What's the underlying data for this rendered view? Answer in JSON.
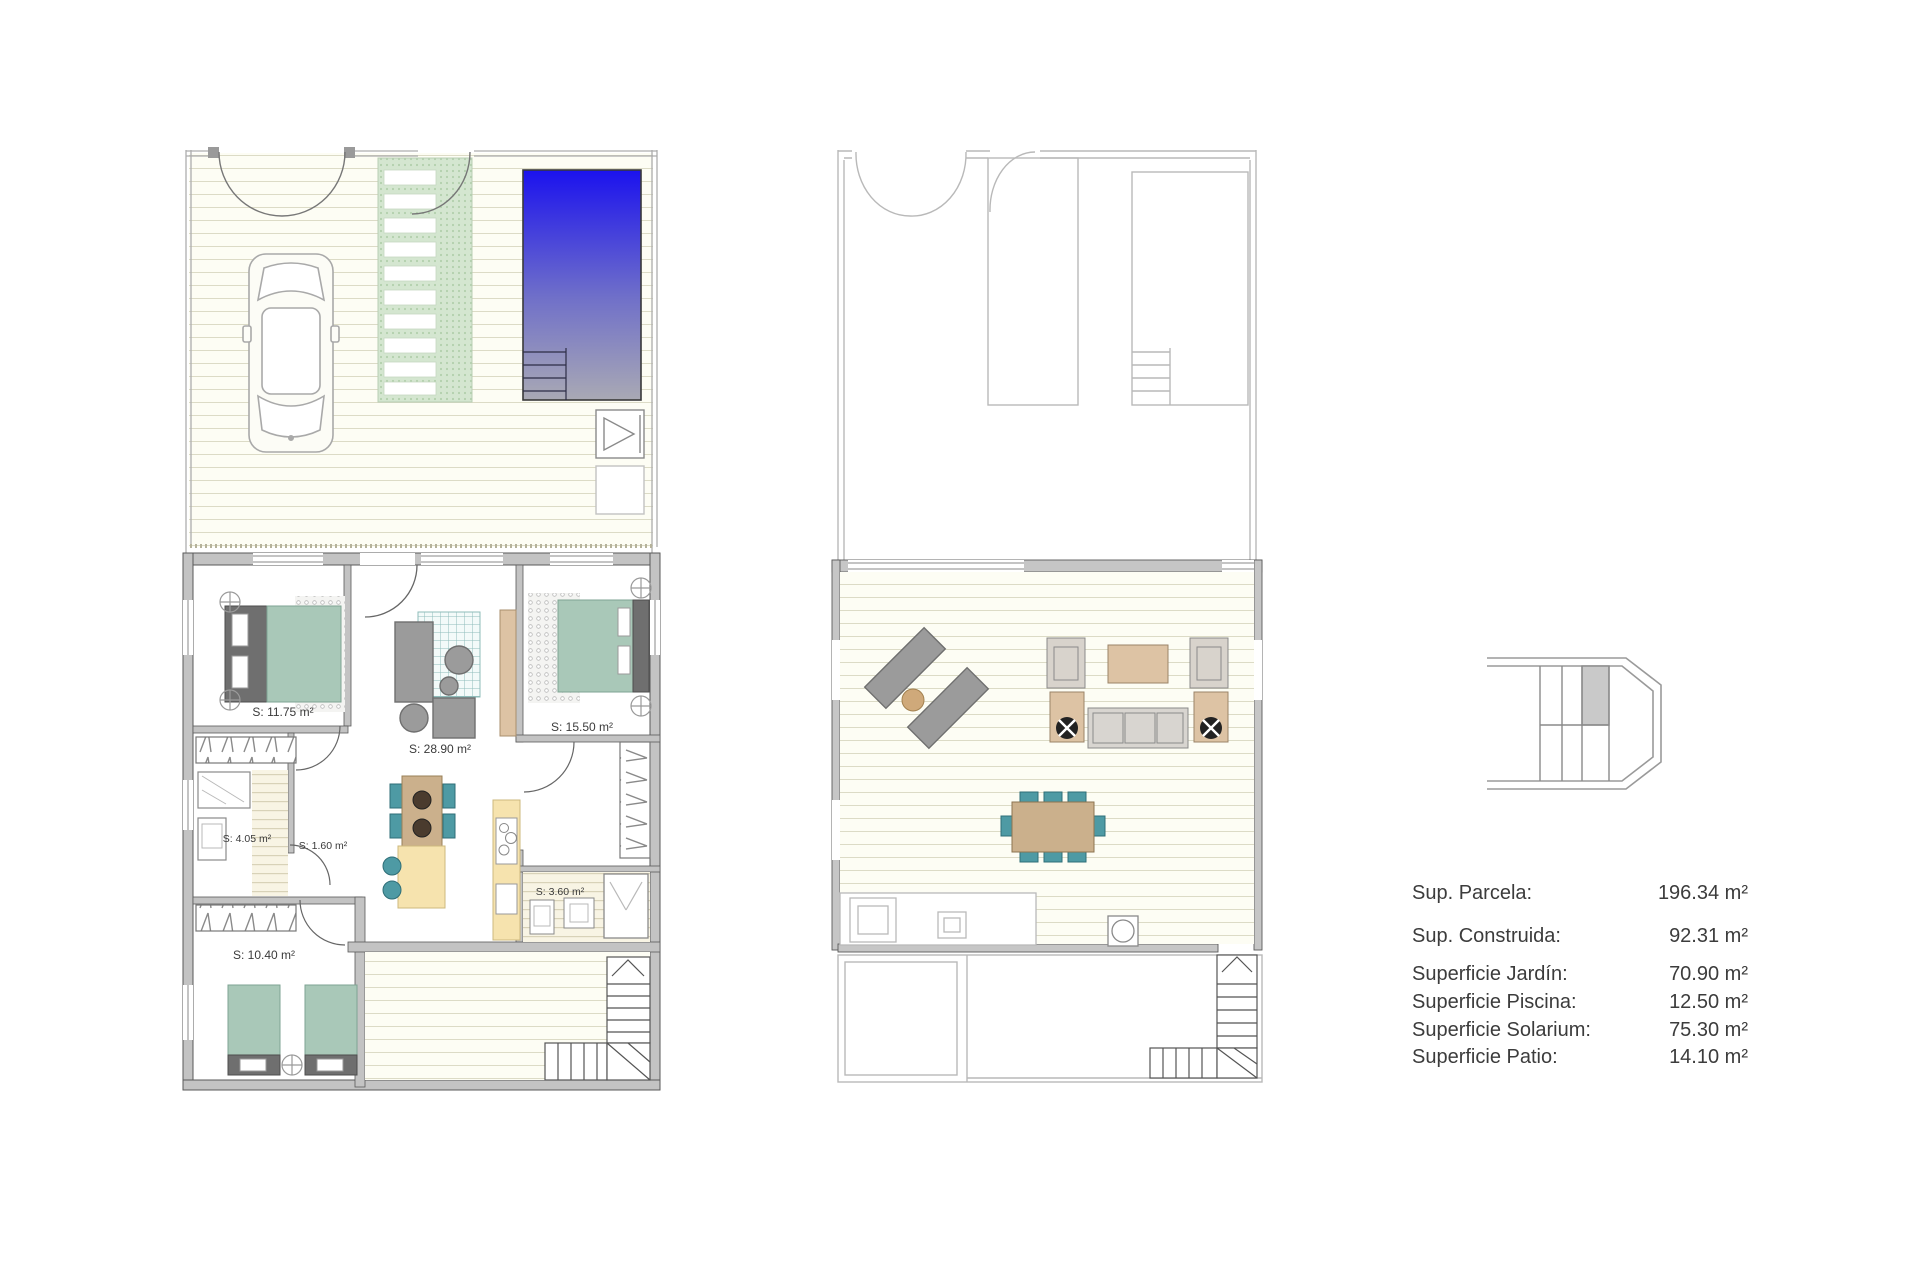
{
  "document": {
    "background": "#ffffff",
    "type": "floor-plan-sheet"
  },
  "plans": {
    "ground": {
      "title": "ground-floor-plan",
      "rooms": [
        {
          "id": "bedroom-1",
          "label": "S: 11.75 m²"
        },
        {
          "id": "living-kitchen",
          "label": "S: 28.90 m²"
        },
        {
          "id": "bedroom-2",
          "label": "S: 15.50 m²"
        },
        {
          "id": "bathroom-1",
          "label": "S: 4.05 m²"
        },
        {
          "id": "hall",
          "label": "S: 1.60 m²"
        },
        {
          "id": "bathroom-2",
          "label": "S: 3.60 m²"
        },
        {
          "id": "bedroom-3",
          "label": "S: 10.40 m²"
        }
      ],
      "features": [
        "garden-deck",
        "parking-car",
        "stepping-stone-path",
        "swimming-pool",
        "outdoor-shower",
        "patio-deck",
        "corner-staircase"
      ]
    },
    "upper": {
      "title": "solarium-floor-plan",
      "features": [
        "lower-floor-outline",
        "solarium-deck",
        "sun-loungers",
        "lounge-seating-set",
        "parasol-loungers",
        "outdoor-dining-set",
        "summer-kitchen-counter",
        "barbecue",
        "corner-staircase"
      ]
    }
  },
  "location_key": {
    "description": "block-position-key",
    "highlighted_unit": "top-row-third"
  },
  "summary": {
    "rows": [
      {
        "label": "Sup. Parcela:",
        "value": "196.34 m²"
      },
      {
        "label": "Sup. Construida:",
        "value": "92.31 m²"
      },
      {
        "label": "Superficie Jardín:",
        "value": "70.90 m²"
      },
      {
        "label": "Superficie Piscina:",
        "value": "12.50 m²"
      },
      {
        "label": "Superficie Solarium:",
        "value": "75.30 m²"
      },
      {
        "label": "Superficie Patio:",
        "value": "14.10 m²"
      }
    ]
  },
  "colors": {
    "pool_top": "#1b12ee",
    "pool_bottom": "#a9a9b4",
    "bed_green": "#a9c8b8",
    "teal": "#4e9aa4",
    "wood_tan": "#ddc3a4",
    "kitchen_yellow": "#f6e3ae",
    "wall_gray": "#c3c3c3",
    "deck_line": "#dcdbc6",
    "outline_light": "#b9b9b9",
    "path_green": "#d4e6d0",
    "ink": "#3c3c3c"
  }
}
